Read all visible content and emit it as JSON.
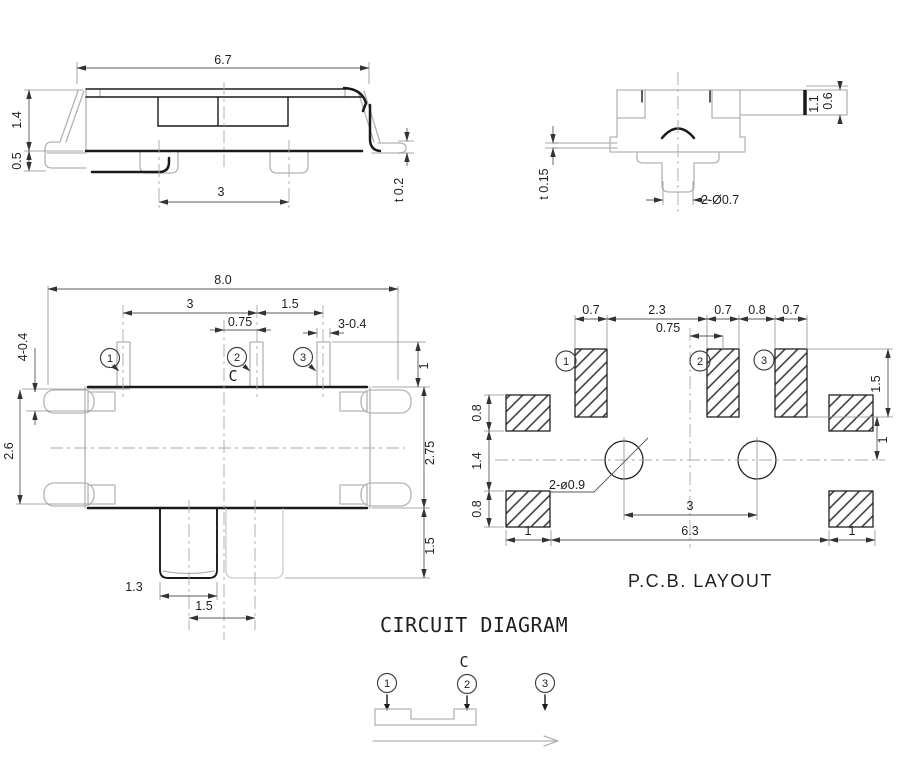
{
  "views": {
    "side": {
      "dims": {
        "width": "6.7",
        "height": "1.4",
        "foot": "0.5",
        "pitch": "3",
        "thickness": "t 0.2"
      }
    },
    "end": {
      "dims": {
        "offset": "1.1",
        "strip": "0.6",
        "thickness": "t 0.15",
        "pins": "2-Ø0.7"
      }
    },
    "bottom": {
      "dims": {
        "total_width": "8.0",
        "pitch12": "3",
        "pitch23": "1.5",
        "center_offset": "0.75",
        "pin_width": "3-0.4",
        "tabs": "4-0.4",
        "pin_protrusion": "1",
        "body_height": "2.6",
        "overall_height": "2.75",
        "knob_height": "1.5",
        "knob_width": "1.3",
        "travel": "1.5"
      },
      "pins": [
        "1",
        "2",
        "3"
      ],
      "common": "C"
    },
    "pcb": {
      "title": "P.C.B. LAYOUT",
      "pads": [
        "1",
        "2",
        "3"
      ],
      "dims": {
        "pad1_w": "0.7",
        "gap12": "2.3",
        "pad2_w": "0.7",
        "gap23": "0.8",
        "pad3_w": "0.7",
        "center_offset": "0.75",
        "side_top_h": "0.8",
        "side_mid": "1.4",
        "side_bot_h": "0.8",
        "pad_h": "1.5",
        "pad_to_center": "1",
        "holes": "2-ø0.9",
        "hole_pitch": "3",
        "span": "6.3",
        "side_left_w": "1",
        "side_right_w": "1"
      }
    },
    "circuit": {
      "title": "CIRCUIT DIAGRAM",
      "common": "C",
      "terminals": [
        "1",
        "2",
        "3"
      ]
    }
  }
}
